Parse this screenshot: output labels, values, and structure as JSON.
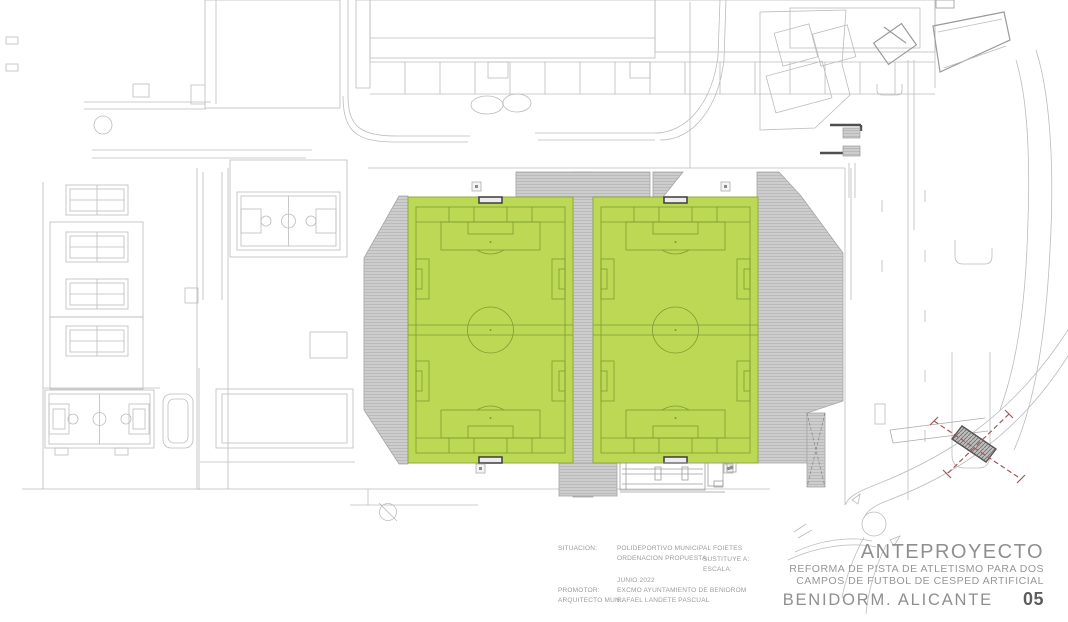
{
  "drawing": {
    "type": "architectural-site-plan",
    "subject": "Two artificial turf football fields replacing an athletics track at a municipal sports complex"
  },
  "info_block": {
    "situacion_label": "SITUACION:",
    "situacion_value": "POLIDEPORTIVO MUNICIPAL FOIETES",
    "ordenacion": "ORDENACION PROPUESTA",
    "sustituye_label": "SUSTITUYE A:",
    "escala_label": "ESCALA:",
    "fecha": "JUNIO 2022",
    "promotor_label": "PROMOTOR:",
    "promotor_value": "EXCMO AYUNTAMIENTO DE BENIDROM",
    "arquitecto_label": "ARQUITECTO MUN.:",
    "arquitecto_value": "RAFAEL LANDETE PASCUAL"
  },
  "title_block": {
    "project_phase": "ANTEPROYECTO",
    "subtitle_line1": "REFORMA DE PISTA DE ATLETISMO PARA DOS",
    "subtitle_line2": "CAMPOS DE FUTBOL DE CESPED ARTIFICIAL",
    "location": "BENIDORM. ALICANTE",
    "sheet_number": "05"
  },
  "colors": {
    "pitch_green": "#bdd854",
    "pitch_line": "#7d9c33",
    "hatch_fill": "#cdcdcd",
    "hatch_line": "#b4b4b4",
    "linework_gray": "#b9b9b9",
    "dark_detail": "#4f4f4f",
    "red_dashed": "#a25757",
    "title_text": "#8f8f8f"
  }
}
